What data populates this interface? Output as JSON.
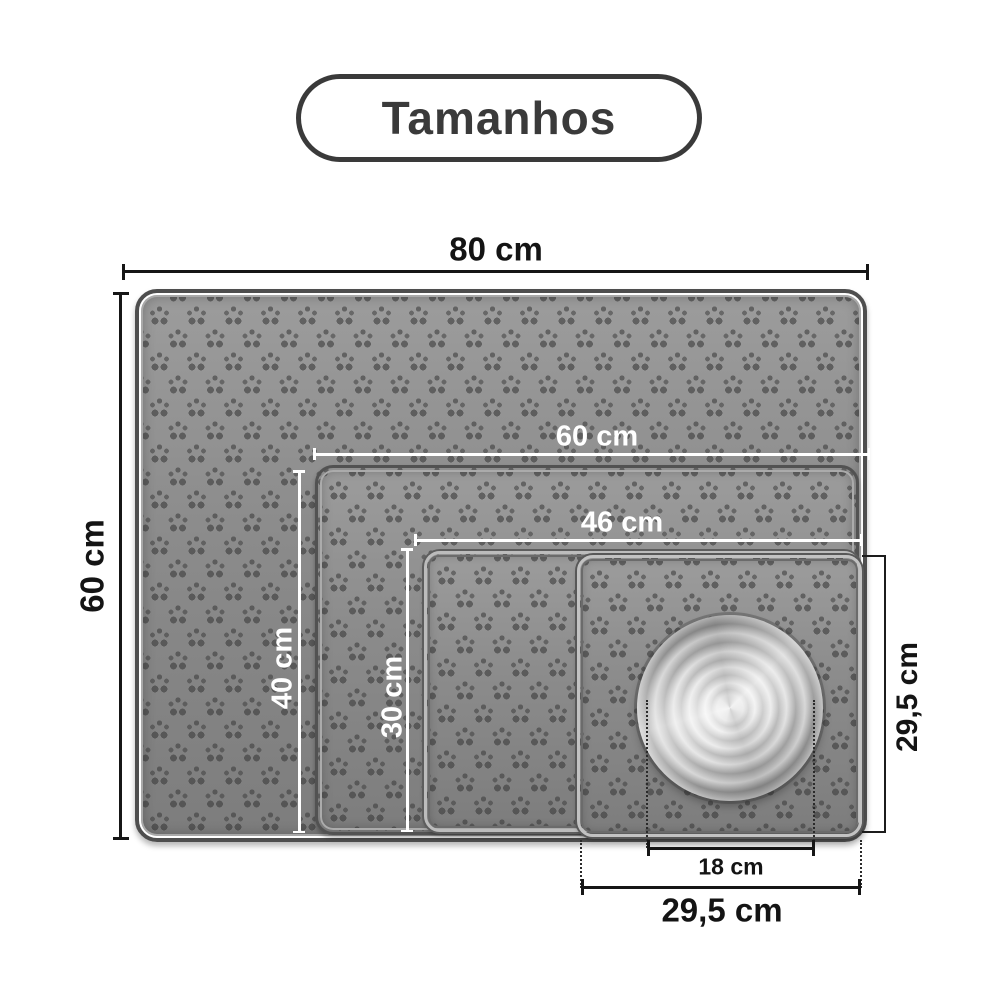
{
  "title": {
    "text": "Tamanhos"
  },
  "dimensions": {
    "mat1_width": "80 cm",
    "mat1_height": "60 cm",
    "mat2_width": "60 cm",
    "mat2_height": "40 cm",
    "mat3_width": "46 cm",
    "mat3_height": "30 cm",
    "mat4_width": "29,5 cm",
    "mat4_height": "29,5 cm",
    "bowl_diameter": "18 cm"
  },
  "mats": [
    {
      "name": "mat-80x60",
      "width_label": "80 cm",
      "height_label": "60 cm"
    },
    {
      "name": "mat-60x40",
      "width_label": "60 cm",
      "height_label": "40 cm"
    },
    {
      "name": "mat-46x30",
      "width_label": "46 cm",
      "height_label": "30 cm"
    },
    {
      "name": "mat-29_5x29_5",
      "width_label": "29,5 cm",
      "height_label": "29,5 cm"
    }
  ],
  "bowl": {
    "diameter_label": "18 cm"
  },
  "colors": {
    "badge_outline": "#3a3a3a",
    "mat_gray": "#8c8c8c",
    "dim_dark": "#161616",
    "dim_white": "#ffffff",
    "background": "#ffffff"
  }
}
